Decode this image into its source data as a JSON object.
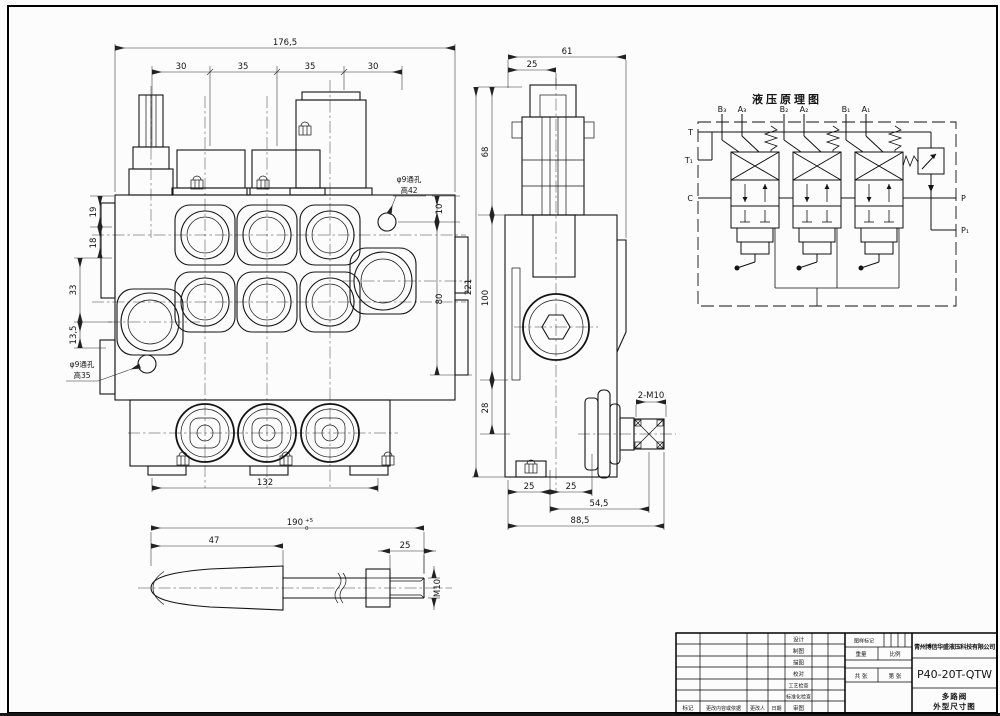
{
  "front": {
    "dim_total": "176,5",
    "dim_s1": "30",
    "dim_s2": "35",
    "dim_s3": "35",
    "dim_s4": "30",
    "dim_l19": "19",
    "dim_l18": "18",
    "dim_l33": "33",
    "dim_l135": "13,5",
    "dim_r10": "10",
    "dim_r80": "80",
    "dim_b132": "132",
    "hole_tr_l1": "φ9通孔",
    "hole_tr_l2": "高42",
    "hole_bl_l1": "φ9通孔",
    "hole_bl_l2": "高35"
  },
  "side": {
    "dim_61": "61",
    "dim_25": "25",
    "dim_68": "68",
    "dim_221": "221",
    "dim_100": "100",
    "dim_28": "28",
    "dim_f25a": "25",
    "dim_f25b": "25",
    "dim_545": "54,5",
    "dim_885": "88,5",
    "thread": "2-M10"
  },
  "schematic": {
    "title": "液压原理图",
    "b3": "B₃",
    "a3": "A₃",
    "b2": "B₂",
    "a2": "A₂",
    "b1": "B₁",
    "a1": "A₁",
    "t": "T",
    "t1": "T₁",
    "c": "C",
    "p": "P",
    "p1": "P₁"
  },
  "lever": {
    "dim_len": "190",
    "tol_up": "+5",
    "tol_dn": "0",
    "dim_47": "47",
    "dim_25": "25",
    "thread": "M10"
  },
  "titleblock": {
    "company": "青州博信华盛液压科技有限公司",
    "model": "P40-20T-QTW",
    "product_line1": "多路阀",
    "product_line2": "外型尺寸图",
    "col_labels": [
      "设计",
      "制图",
      "描图",
      "校对",
      "工艺检查",
      "标准化检查",
      "审图"
    ],
    "bottom_labels": [
      "标记",
      "更改内容或依据",
      "更改人",
      "日期"
    ],
    "mark_label": "图样标记",
    "weight_label": "重量",
    "scale_label": "比例",
    "sheets_label": "共 张",
    "sheetno_label": "第 张"
  }
}
